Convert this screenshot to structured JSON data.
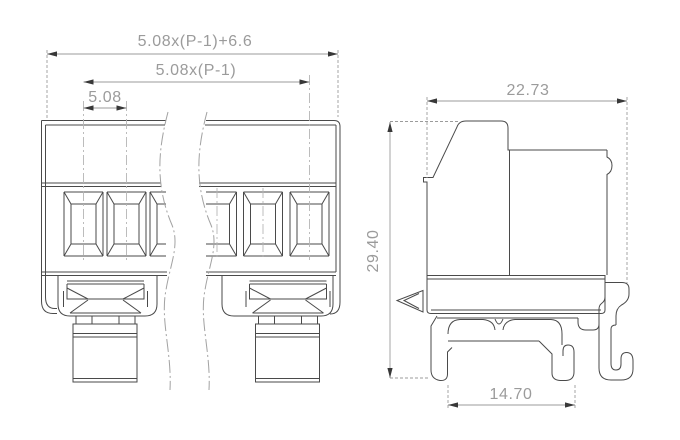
{
  "drawing": {
    "type": "technical-dimension-drawing",
    "subject": "pluggable terminal block, front view (broken) and side view on DIN rail",
    "colors": {
      "background": "#ffffff",
      "geometry_line": "#4a4a4a",
      "dimension_line": "#9b9b9b",
      "dimension_text": "#9b9b9b",
      "arrow": "#383838",
      "centerline": "#b5b5b5",
      "breakline": "#a2a2a2"
    },
    "front_view": {
      "dims": {
        "total_width": "5.08x(P-1)+6.6",
        "pitch_span": "5.08x(P-1)",
        "pitch": "5.08"
      }
    },
    "side_view": {
      "dims": {
        "depth": "22.73",
        "height": "29.40",
        "rail_slot_width": "14.70"
      }
    }
  }
}
